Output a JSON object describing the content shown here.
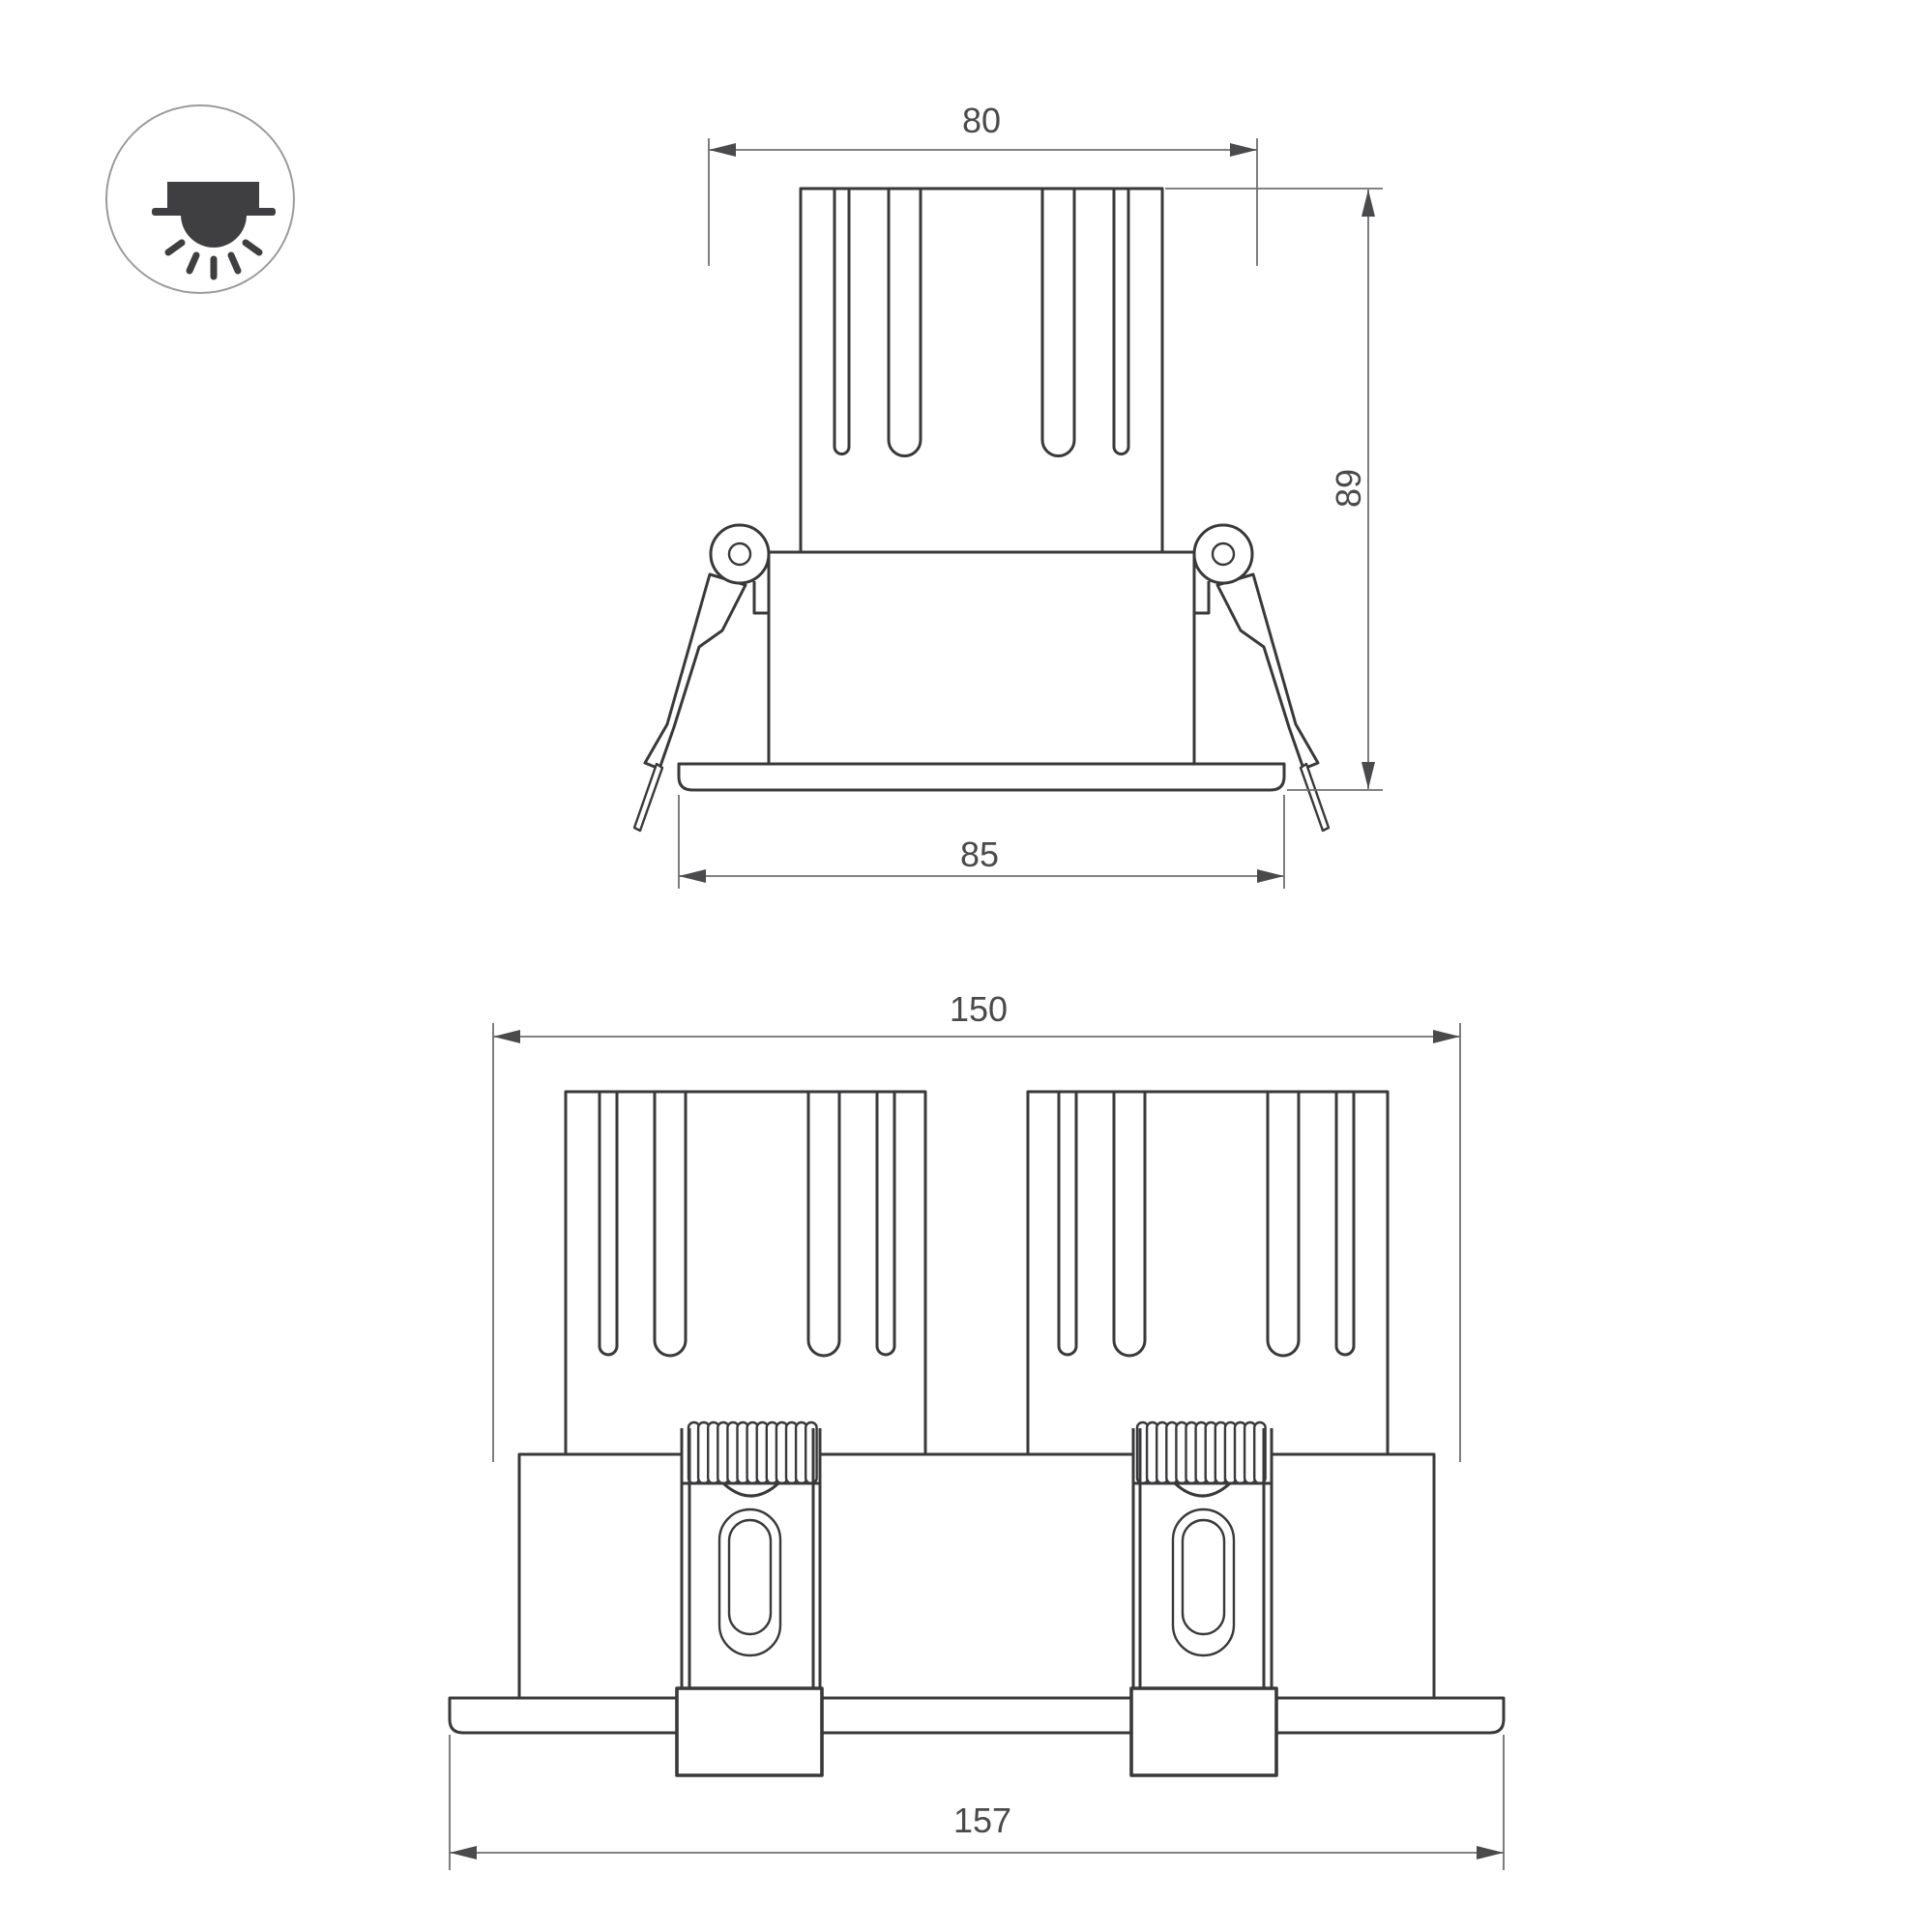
{
  "icon": {
    "name": "recessed-downlight-icon"
  },
  "drawing": {
    "type": "technical dimension drawing of recessed LED downlights",
    "views": [
      {
        "id": "front-single",
        "dimensions": {
          "cutout_width": "80",
          "height": "89",
          "flange_width": "85"
        }
      },
      {
        "id": "front-double",
        "dimensions": {
          "body_width": "150",
          "flange_width": "157"
        }
      }
    ]
  },
  "colors": {
    "object_line": "#39393b",
    "dimension_line": "#707072",
    "dimension_text": "#4a4a4c",
    "icon_glyph": "#3f3f41",
    "background": "#ffffff"
  }
}
